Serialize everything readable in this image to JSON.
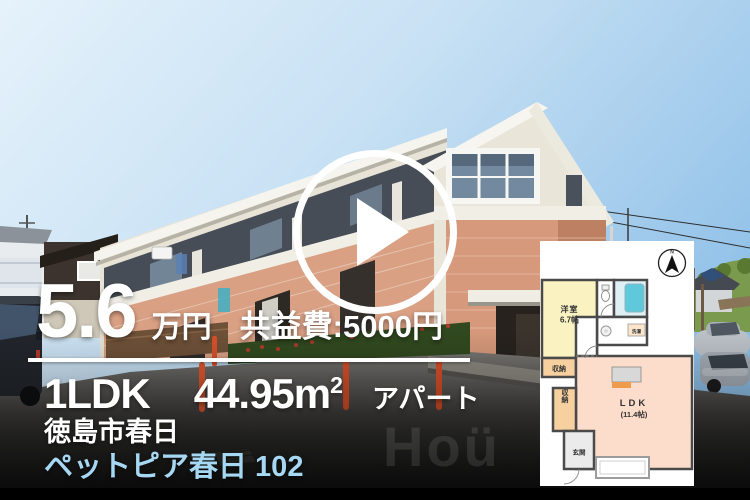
{
  "listing": {
    "price": "5.6",
    "price_unit": "万円",
    "common_fee": "共益費:5000円",
    "layout": "1LDK",
    "area": "44.95m",
    "area_exponent": "2",
    "building_type": "アパート",
    "address": "徳島市春日",
    "property_name": "ペットピア春日 102"
  },
  "floor_plan": {
    "compass": "N",
    "bedroom_label": "洋室",
    "bedroom_size": "6.7帖",
    "ldk_label": "LDK",
    "ldk_size": "(11.4帖)",
    "closet1_label": "収納",
    "closet2_label": "収納",
    "entrance_label": "玄関",
    "laundry_label": "洗濯"
  },
  "watermark": "Hoü",
  "colors": {
    "property_name_text": "#a6d7f3",
    "overlay_text": "#ffffff",
    "bollard_orange": "#d9512c",
    "floorplan_bedroom": "#faf3c1",
    "floorplan_ldk": "#fcdcca",
    "floorplan_closet": "#f6d09e",
    "floorplan_bath": "#5fc8db",
    "bottom_bar": "#000000"
  }
}
